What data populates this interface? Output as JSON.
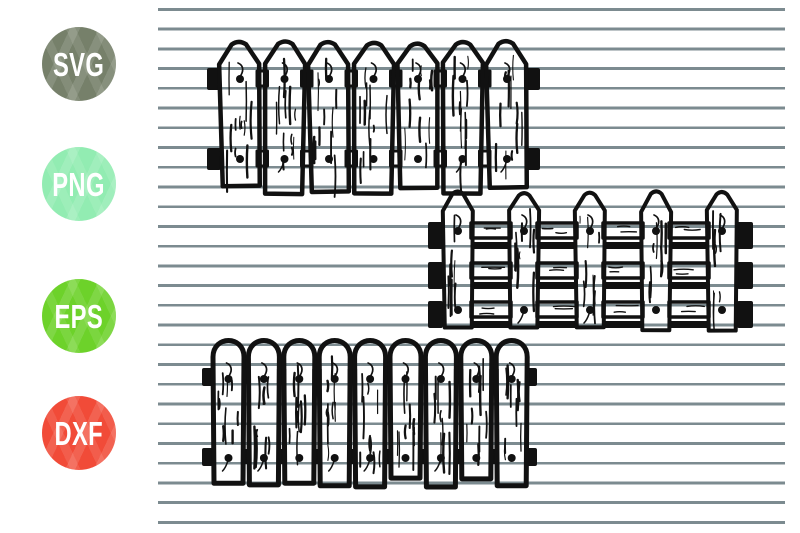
{
  "badges": [
    {
      "id": "svg",
      "label": "SVG",
      "color": "#76806A"
    },
    {
      "id": "png",
      "label": "PNG",
      "color": "#92ECB2"
    },
    {
      "id": "eps",
      "label": "EPS",
      "color": "#6DD22A"
    },
    {
      "id": "dxf",
      "label": "DXF",
      "color": "#F14B38"
    }
  ],
  "background": {
    "paper_color": "#FFFFFF",
    "ruled_line_color": "#7C8B90"
  },
  "artwork": {
    "ink_color": "#111111",
    "fences": [
      {
        "name": "pointed-picket-fence-tight",
        "picket_style": "pointed",
        "picket_count": 7,
        "rail_count": 2
      },
      {
        "name": "pointed-picket-fence-spaced",
        "picket_style": "pointed",
        "picket_count": 5,
        "rail_count": 3
      },
      {
        "name": "round-picket-fence-tight",
        "picket_style": "round",
        "picket_count": 9,
        "rail_count": 2
      }
    ]
  }
}
